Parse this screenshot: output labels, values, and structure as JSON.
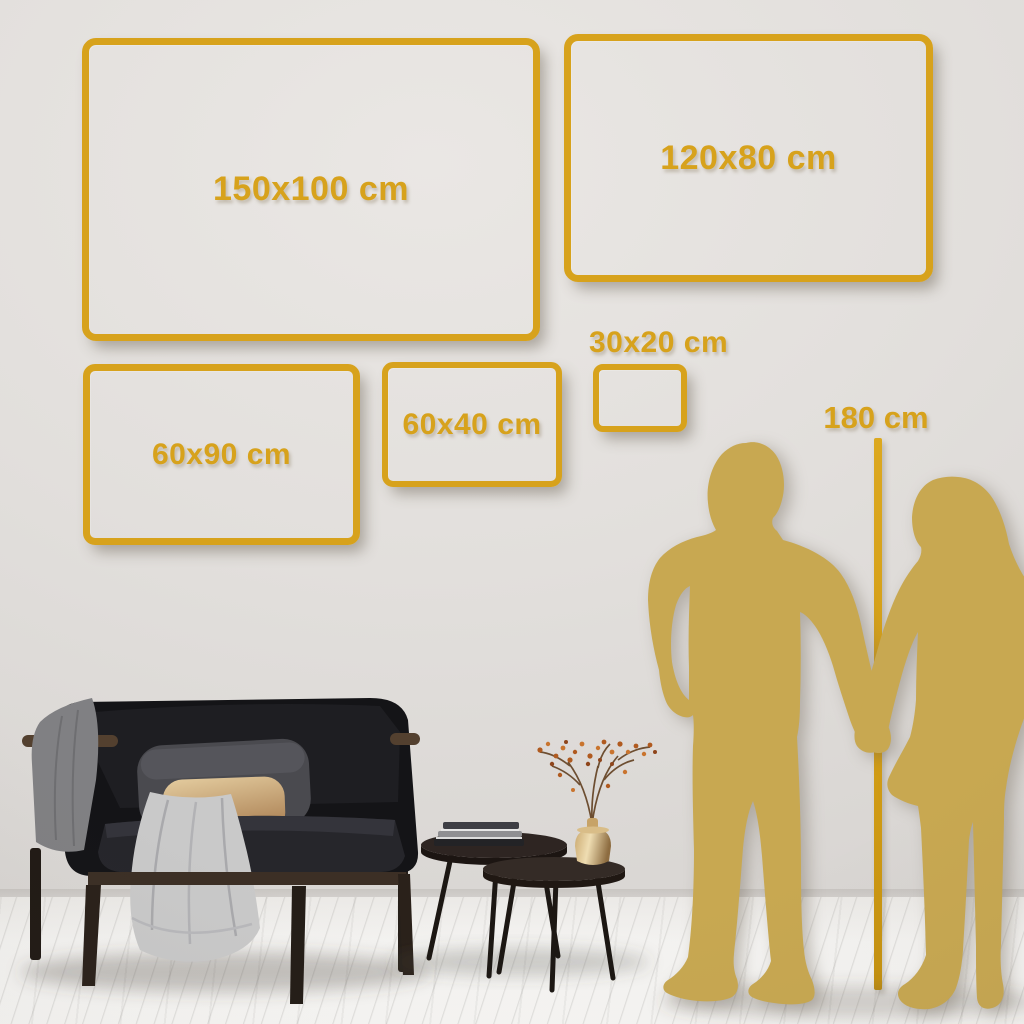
{
  "size_guide": {
    "frames": [
      {
        "id": "150x100",
        "label": "150x100 cm"
      },
      {
        "id": "120x80",
        "label": "120x80 cm"
      },
      {
        "id": "30x20",
        "label": "30x20 cm"
      },
      {
        "id": "60x40",
        "label": "60x40 cm"
      },
      {
        "id": "60x90",
        "label": "60x90 cm"
      }
    ],
    "height_reference": {
      "label": "180 cm"
    }
  },
  "colors": {
    "frame_gold": "#D7A21C",
    "height_line_gold": "#D19C15",
    "silhouette_gold": "#C8A851",
    "wall_gray": "#E2DFDC",
    "floor_white": "#F4F3F1",
    "sofa_black": "#17171A",
    "pillow_gray": "#4A4A4F",
    "pillow_tan": "#D3B384",
    "blanket_light_gray": "#C9C9C9",
    "blanket_dark_gray": "#808083",
    "wood_brown": "#53402F",
    "table_wood_dark": "#2E2522",
    "vase_brass": "#C9A96F",
    "berry_orange": "#B05A1F"
  },
  "scene": {
    "furniture": [
      "sofa",
      "throw-blanket",
      "pillows",
      "nesting-coffee-tables",
      "books",
      "brass-vase",
      "dried-branch-plant"
    ],
    "figures": [
      "man-silhouette",
      "woman-silhouette"
    ]
  }
}
